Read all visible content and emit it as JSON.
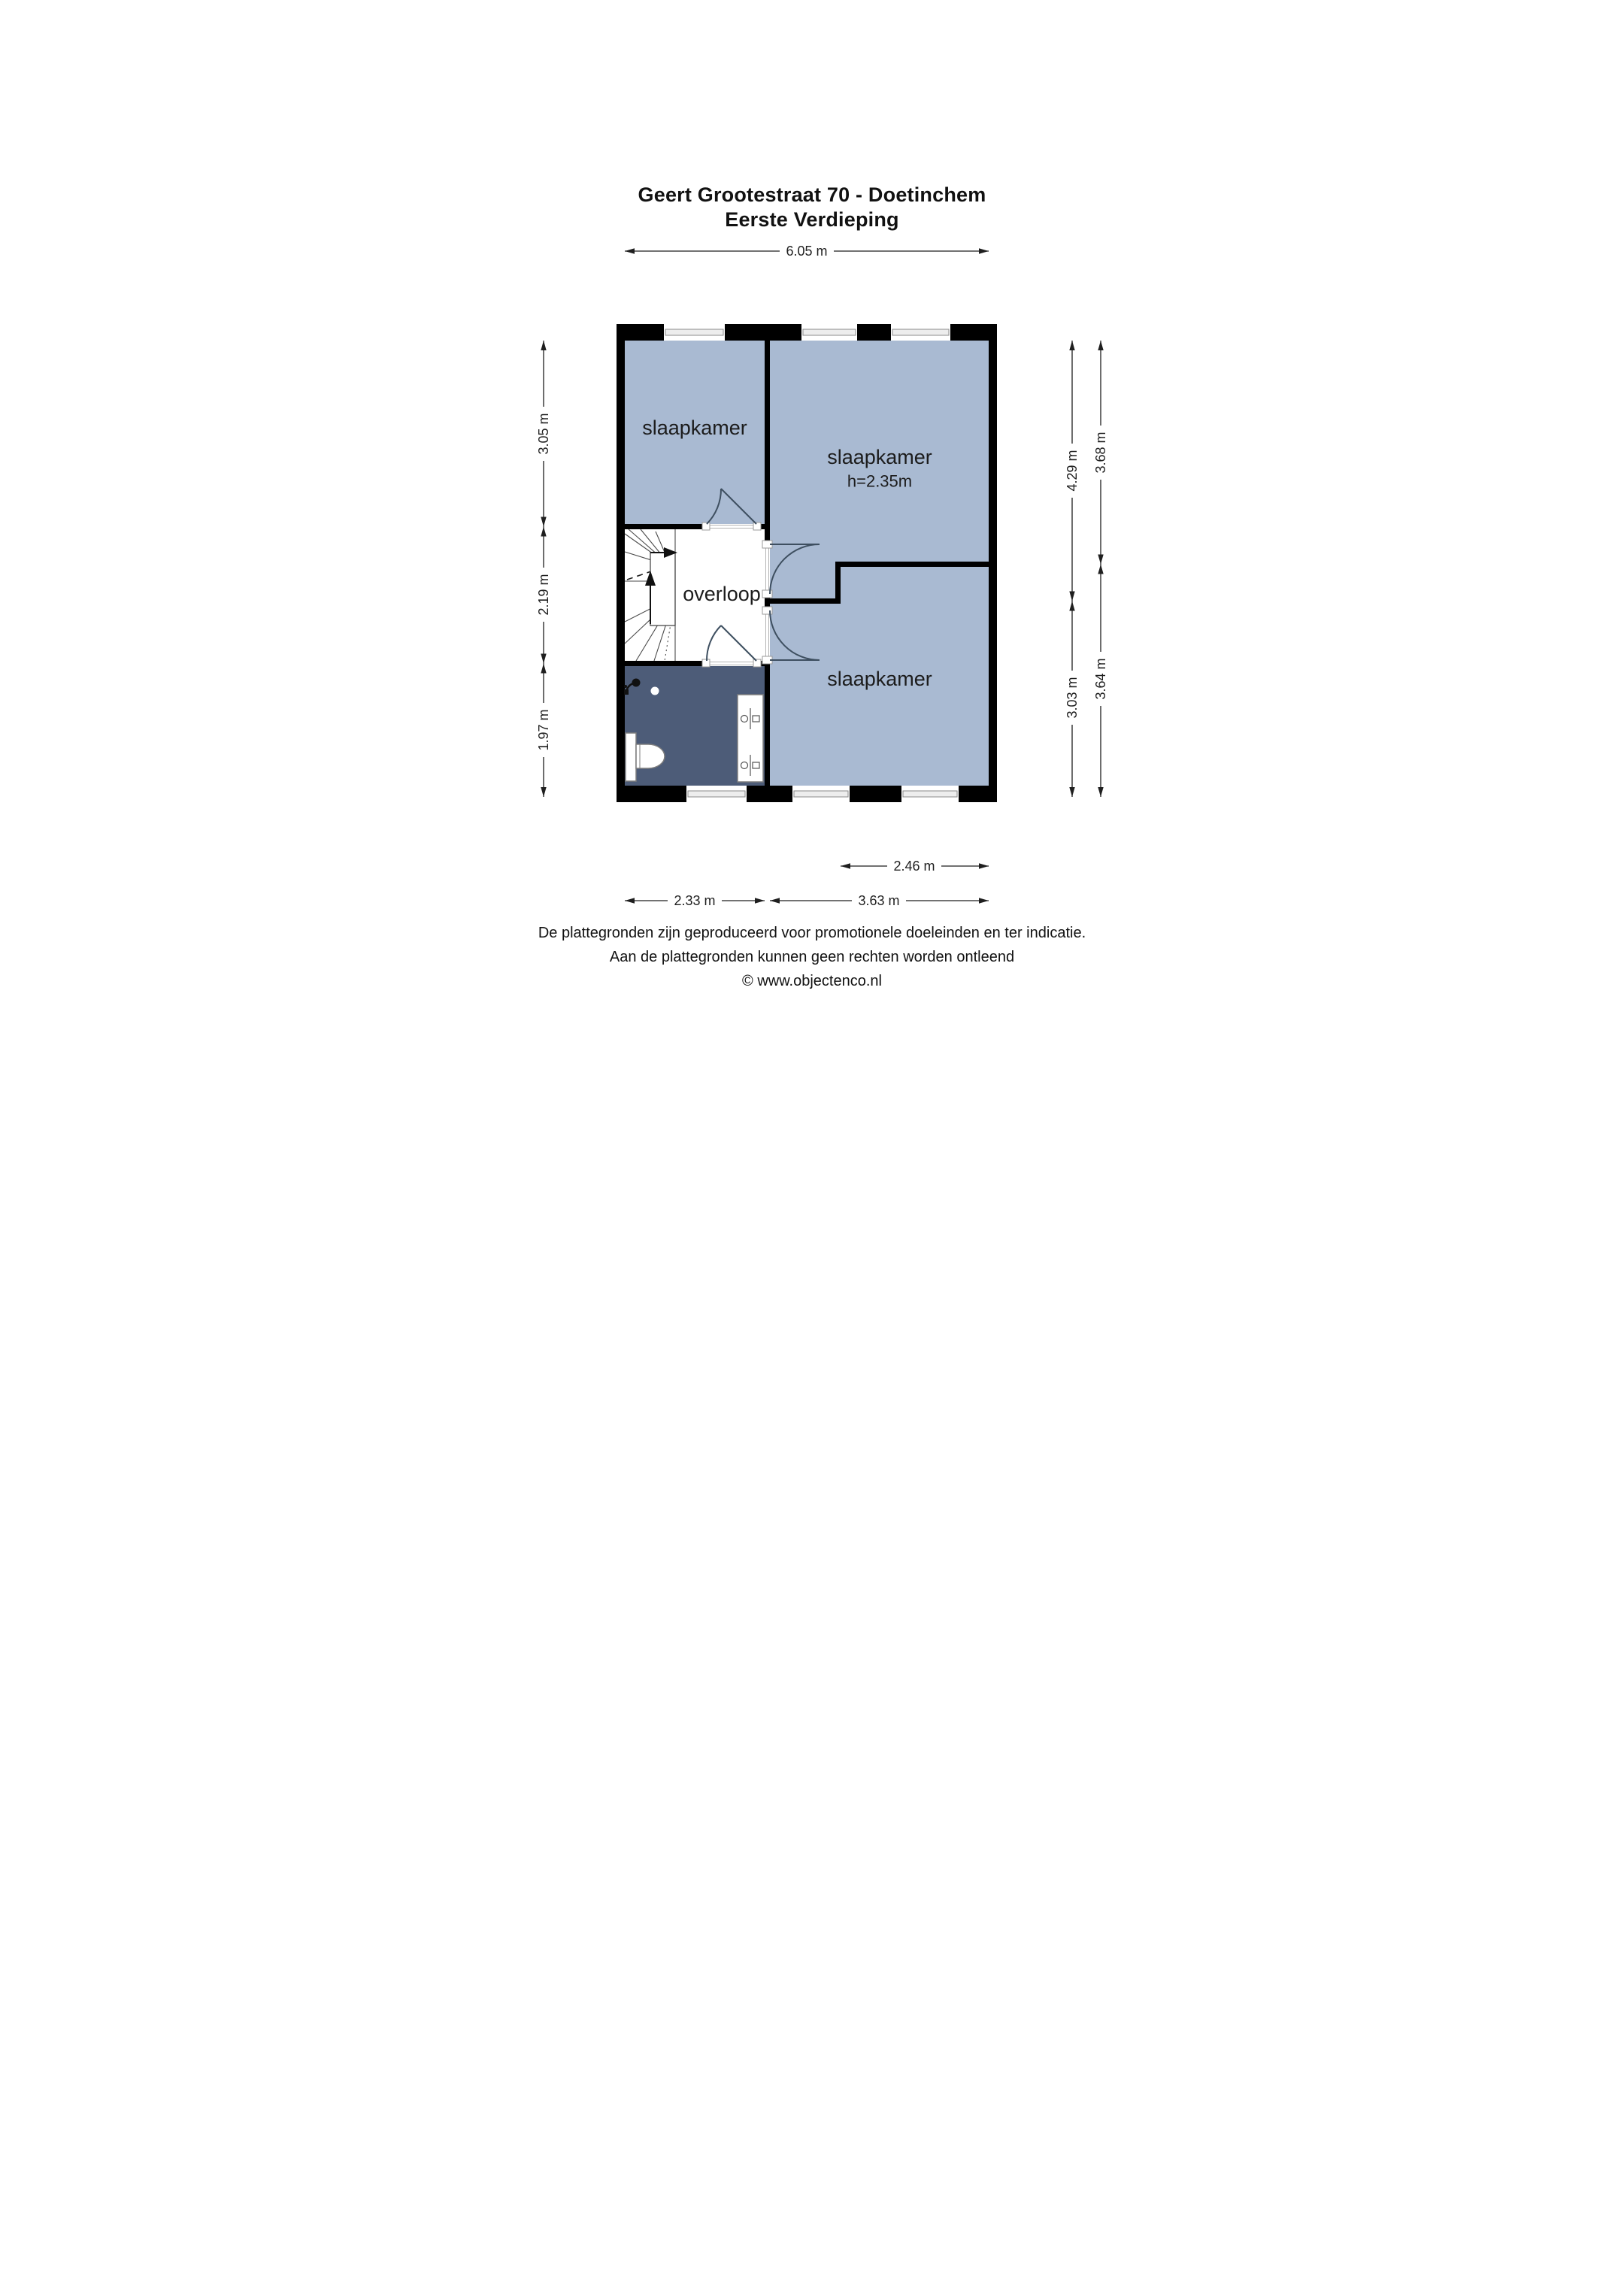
{
  "title": {
    "line1": "Geert Grootestraat 70 - Doetinchem",
    "line2": "Eerste Verdieping"
  },
  "rooms": {
    "bedroom_top_left": "slaapkamer",
    "bedroom_right": "slaapkamer",
    "bedroom_right_note": "h=2.35m",
    "landing": "overloop",
    "bedroom_bottom_right": "slaapkamer"
  },
  "dimensions": {
    "top_width": "6.05 m",
    "left": [
      "3.05 m",
      "2.19 m",
      "1.97 m"
    ],
    "right_inner": [
      "4.29 m",
      "3.03 m"
    ],
    "right_outer": [
      "3.68 m",
      "3.64 m"
    ],
    "bottom_right_width": "2.46 m",
    "bottom": [
      "2.33 m",
      "3.63 m"
    ]
  },
  "footer": {
    "line1": "De plattegronden zijn geproduceerd voor promotionele doeleinden en ter indicatie.",
    "line2": "Aan de plattegronden kunnen geen rechten worden ontleend",
    "line3": "© www.objectenco.nl"
  },
  "colors": {
    "room_fill": "#a9bad2",
    "bathroom_fill": "#4d5c78",
    "wall": "#000000",
    "window_glass": "#ededed",
    "door_arc": "#3e4f60"
  }
}
